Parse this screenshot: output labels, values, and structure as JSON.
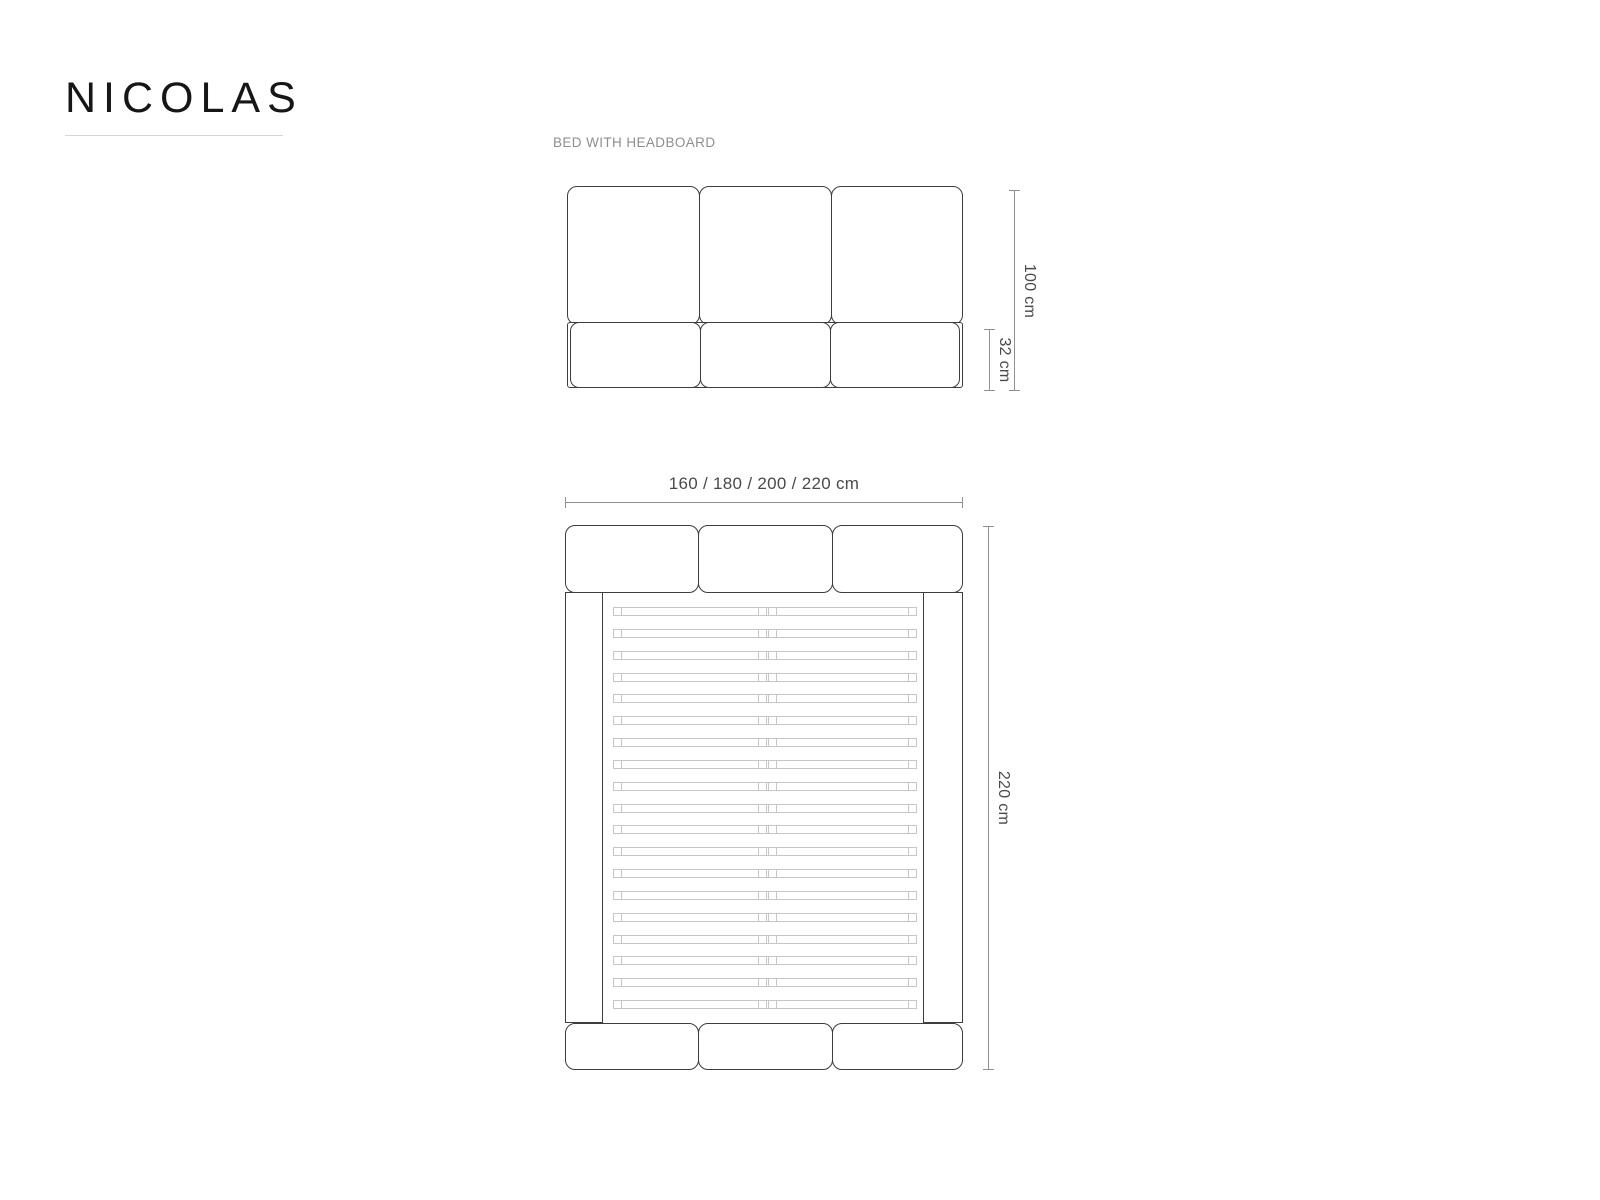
{
  "brand": {
    "title": "NICOLAS"
  },
  "view_label": "BED WITH HEADBOARD",
  "front_view": {
    "headboard_height_label": "100 cm",
    "base_height_label": "32 cm"
  },
  "top_view": {
    "width_label": "160 / 180 / 200 / 220 cm",
    "length_label": "220 cm",
    "slat_count": 19
  },
  "colors": {
    "outline": "#3d3d3d",
    "slat": "#c6c6c6",
    "dimension_line": "#909090",
    "dimension_text": "#4a4a4a"
  }
}
